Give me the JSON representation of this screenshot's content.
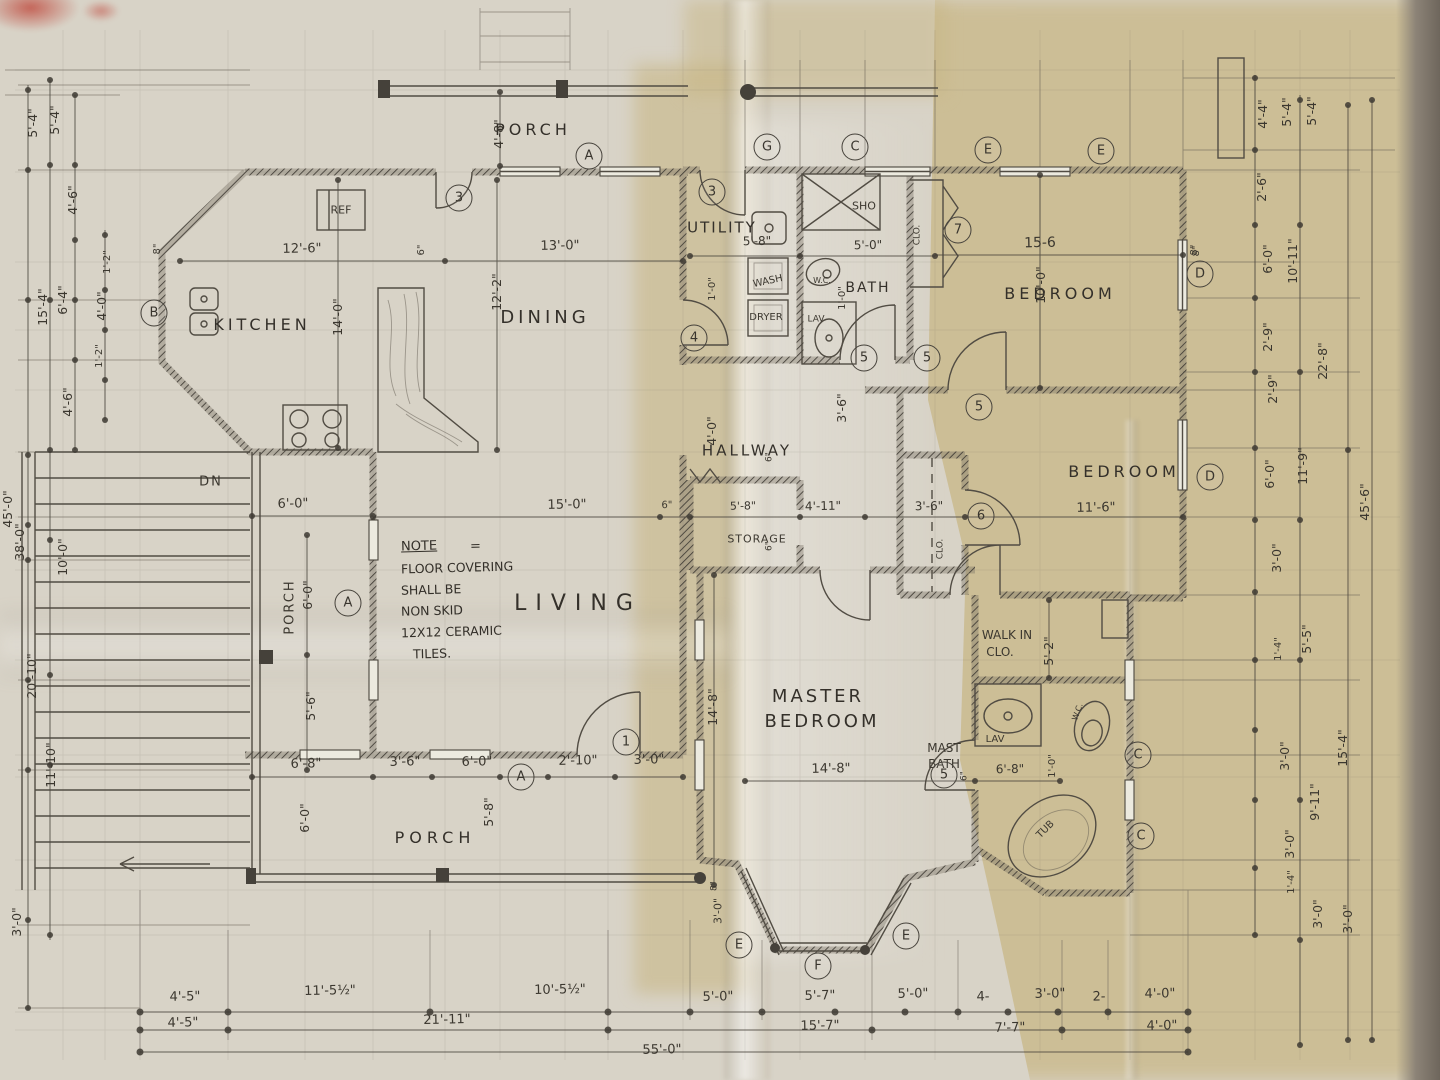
{
  "colors": {
    "paper_light": "#d8d3c7",
    "paper_tan": "#c8b684",
    "pencil": "#4b463e",
    "table_edge": "#6e665c",
    "red_mark": "#c2574b"
  },
  "rooms": {
    "porch_top": "PORCH",
    "kitchen": "KITCHEN",
    "dining": "DINING",
    "utility": "UTILITY",
    "bath": "BATH",
    "bedroom1": "BEDROOM",
    "bedroom2": "BEDROOM",
    "hallway": "HALLWAY",
    "storage": "STORAGE",
    "living": "LIVING",
    "master1": "MASTER",
    "master2": "BEDROOM",
    "walkin1": "WALK IN",
    "walkin2": "CLO.",
    "mastbath1": "MAST",
    "mastbath2": "BATH",
    "porch_bottom": "PORCH",
    "porch_left": "PORCH"
  },
  "fixtures": {
    "ref": "REF",
    "wash": "WASH",
    "dryer": "DRYER",
    "wc": "W.C.",
    "lav": "LAV",
    "sho": "SHO",
    "clo_bath": "CLO.",
    "clo_bed2": "CLO.",
    "tub": "TUB",
    "lav_mast": "LAV",
    "wc_mast": "W.C.",
    "dn": "DN"
  },
  "note": {
    "title": "NOTE",
    "eq": "=",
    "line1": "FLOOR COVERING",
    "line2": "SHALL BE",
    "line3": "NON SKID",
    "line4": "12X12 CERAMIC",
    "line5": "TILES."
  },
  "markers": {
    "a1": "A",
    "a2": "A",
    "a3": "A",
    "b1": "B",
    "c1": "C",
    "c2": "C",
    "c3": "C",
    "d1": "D",
    "d2": "D",
    "e1": "E",
    "e2": "E",
    "e3": "E",
    "e4": "E",
    "f1": "F",
    "g1": "G",
    "n1": "1",
    "n3a": "3",
    "n3b": "3",
    "n4": "4",
    "n5a": "5",
    "n5b": "5",
    "n5c": "5",
    "n5d": "5",
    "n6": "6",
    "n7": "7"
  },
  "dims": {
    "kitchen_w": "12'-6\"",
    "dining_w": "13'-0\"",
    "dining_h": "12'-2\"",
    "kitchen_h": "14'-0\"",
    "porch_top_d": "4'-8\"",
    "six_a": "6\"",
    "eight_a": "8\"",
    "utility_w": "5'-8\"",
    "one_a": "1'-0\"",
    "bath_w": "5'-0\"",
    "one_b": "1'-0\"",
    "bed1_h": "10'-0\"",
    "eight_b": "8\"",
    "bed1_w": "15-6",
    "living_w": "15'-0\"",
    "six_b": "6\"",
    "storage_w": "5'-8\"",
    "hall_w": "4'-11\"",
    "clo2_w": "3'-6\"",
    "bed2_w": "11'-6\"",
    "bed2_h": "11'-6\"",
    "hall_h": "4'-0\"",
    "hall_h2": "3'-6\"",
    "six_c": "6\"",
    "six_d": "6\"",
    "master_h": "14'-8\"",
    "master_w": "14'-8\"",
    "six_e": "6\"",
    "mastbath_w": "6'-8\"",
    "one_c": "1'-0\"",
    "walkin_h": "5'-2\"",
    "bay_d": "3'-0\"",
    "eight_c": "8\"",
    "porchb_1": "6'-8\"",
    "porchb_2": "3'-6\"",
    "porchb_3": "6'-0\"",
    "porchb_4": "2'-10\"",
    "porchb_5": "3'-0\"",
    "porchb_v1": "5'-8\"",
    "porchb_v2": "6'-0\"",
    "porchl_1": "6'-0\"",
    "porchl_v": "6'-0\"",
    "porchl_v2": "5'-6\"",
    "l1": "5'-4\"",
    "l2": "5'-4\"",
    "l3": "4'-6\"",
    "l4": "15'-4\"",
    "l5": "6'-4\"",
    "l6": "4'-0\"",
    "l7": "1'-2\"",
    "l8": "1'-2\"",
    "l9": "4'-6\"",
    "l10": "45'-0\"",
    "l11": "38'-0\"",
    "l12": "10'-0\"",
    "l13": "20'-10\"",
    "l14": "11'-10\"",
    "l15": "3'-0\"",
    "r1": "4'-4\"",
    "r2": "5'-4\"",
    "r3": "5'-4\"",
    "r4": "2'-6\"",
    "r5": "8\"",
    "r6": "6'-0\"",
    "r7": "10'-11\"",
    "r8": "2'-9\"",
    "r9": "2'-9\"",
    "r10": "22'-8\"",
    "r11": "6'-0\"",
    "r12": "11'-9\"",
    "r13": "45'-6\"",
    "r14": "3'-0\"",
    "r15": "1'-4\"",
    "r16": "5'-5\"",
    "r17": "3'-0\"",
    "r18": "9'-11\"",
    "r19": "15'-4\"",
    "r20": "3'-0\"",
    "r21": "1'-4\"",
    "r22": "3'-0\"",
    "r23": "3'-0\"",
    "b1": "4'-5\"",
    "b2": "11'-5½\"",
    "b3": "10'-5½\"",
    "b4": "5'-0\"",
    "b5": "5'-7\"",
    "b6": "5'-0\"",
    "b7": "4-",
    "b8": "3'-0\"",
    "b9": "2-",
    "b10": "4'-0\"",
    "b11": "4'-5\"",
    "b12": "21'-11\"",
    "b13": "15'-7\"",
    "b14": "7'-7\"",
    "b15": "4'-0\"",
    "b16": "55'-0\""
  }
}
